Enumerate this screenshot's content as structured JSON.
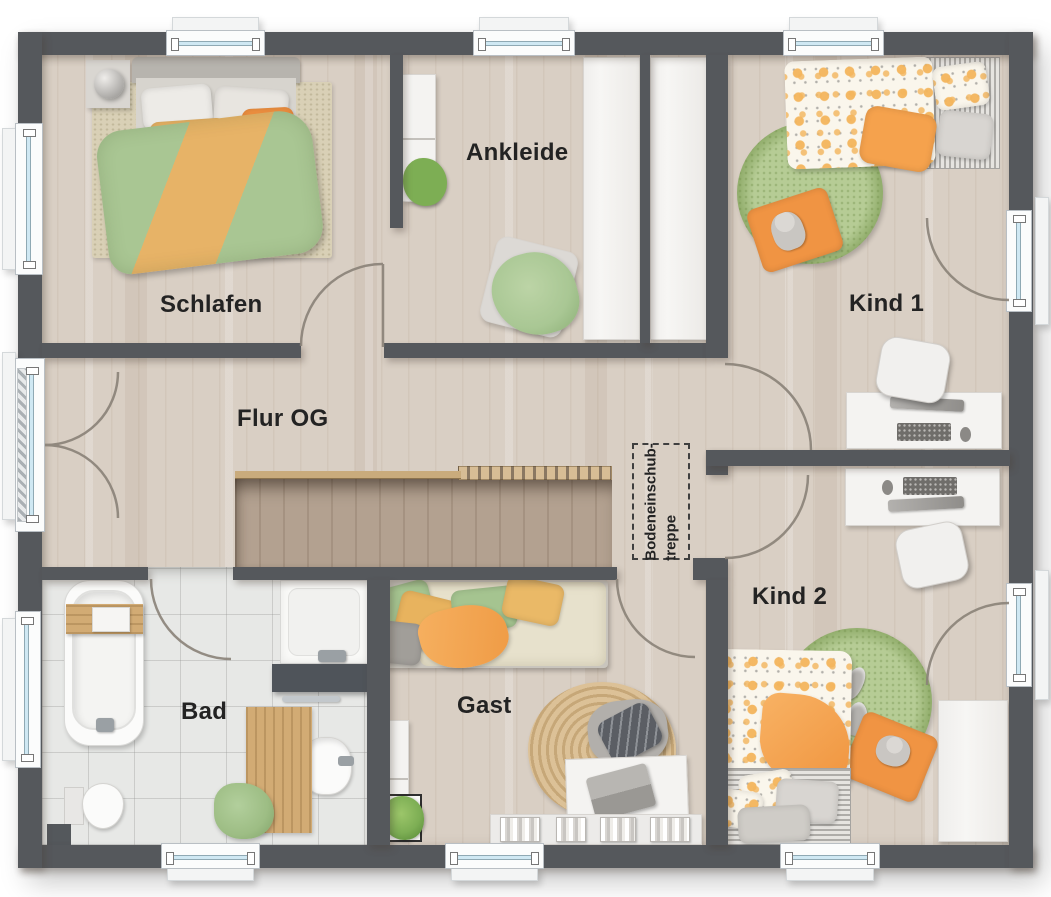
{
  "floorplan": {
    "rooms": {
      "schlafen": {
        "label": "Schlafen"
      },
      "ankleide": {
        "label": "Ankleide"
      },
      "kind1": {
        "label": "Kind 1"
      },
      "flur_og": {
        "label": "Flur OG"
      },
      "bad": {
        "label": "Bad"
      },
      "gast": {
        "label": "Gast"
      },
      "kind2": {
        "label": "Kind 2"
      },
      "attic_hatch": {
        "label_line1": "Bodeneinschub-",
        "label_line2": "treppe"
      }
    },
    "colors": {
      "wall": "#55585c",
      "floor_wood": "#d9cfc4",
      "floor_tile": "#e7e8e6",
      "stair_wood": "#b3a190",
      "railing_wood": "#c9ab7c",
      "rug_green": "#a6c17e",
      "rug_jute": "#d3b384",
      "duvet_green": "#a9c693",
      "accent_orange": "#efa04b",
      "accent_mustard": "#e6b264",
      "glass": "#cfe8f3",
      "arc_stroke": "#8a8278",
      "label_color": "#232323",
      "furniture_white": "#f4f3f1"
    }
  }
}
